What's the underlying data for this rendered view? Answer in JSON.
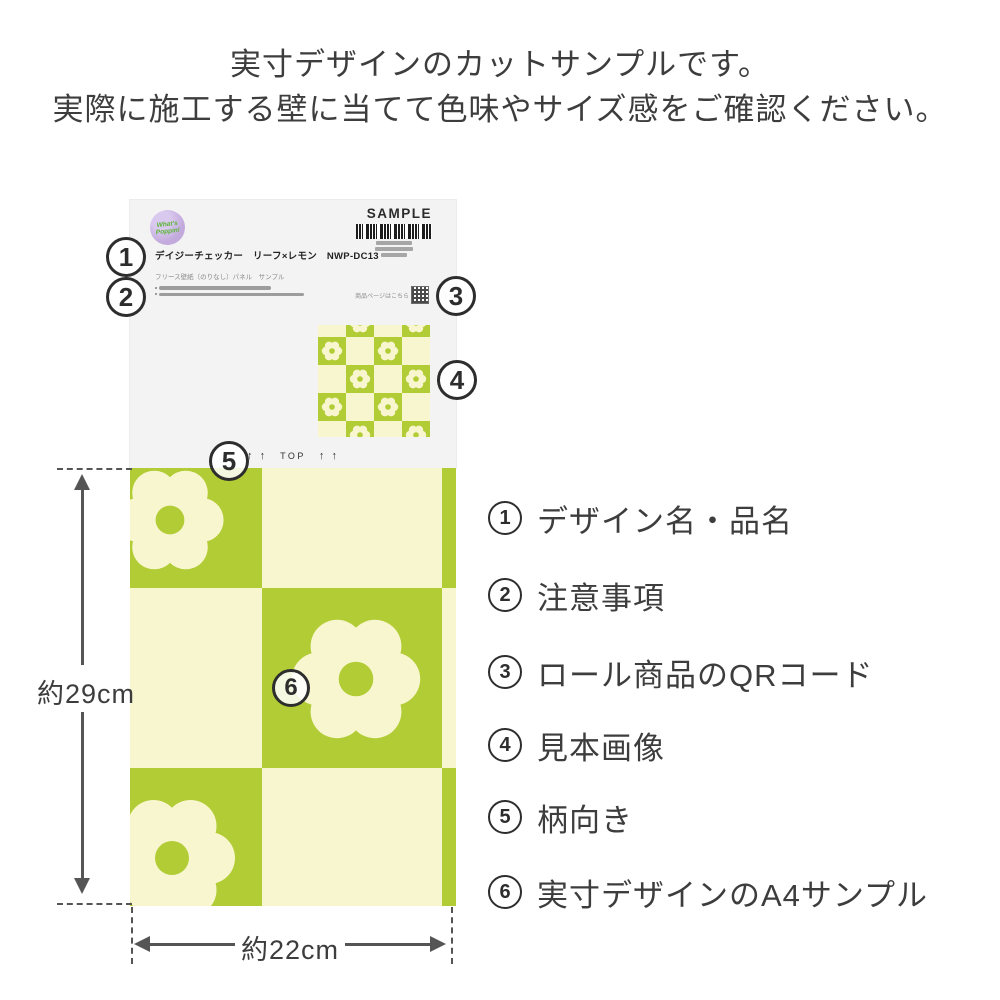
{
  "header": {
    "line1": "実寸デザインのカットサンプルです。",
    "line2": "実際に施工する壁に当てて色味やサイズ感をご確認ください。"
  },
  "card": {
    "badge": {
      "line1": "What's",
      "line2": "Poppin!"
    },
    "sample_label": "SAMPLE",
    "product_name": "デイジーチェッカー　リーフ×レモン　NWP-DC13",
    "product_subtitle": "フリース壁紙（のりなし）パネル　サンプル",
    "qr_caption": "商品ページはこちら",
    "orientation": {
      "arrows": "↑ ↑",
      "label": "TOP"
    }
  },
  "markers": [
    "1",
    "2",
    "3",
    "4",
    "5",
    "6"
  ],
  "dimensions": {
    "height": "約29cm",
    "width": "約22cm"
  },
  "legend": [
    {
      "num": "1",
      "label": "デザイン名・品名"
    },
    {
      "num": "2",
      "label": "注意事項"
    },
    {
      "num": "3",
      "label": "ロール商品のQRコード"
    },
    {
      "num": "4",
      "label": "見本画像"
    },
    {
      "num": "5",
      "label": "柄向き"
    },
    {
      "num": "6",
      "label": "実寸デザインのA4サンプル"
    }
  ],
  "colors": {
    "green": "#b2cc35",
    "cream": "#f8f6cf",
    "label_bg": "#f3f3f3",
    "text_dark": "#3d3d3d",
    "dim_gray": "#555555",
    "marker_ink": "#2d2d2d",
    "badge_purple": "#c2aadd",
    "badge_green": "#58b531",
    "bar_gray": "#a6a6a6",
    "barcode_ink": "#1d1d1d"
  }
}
